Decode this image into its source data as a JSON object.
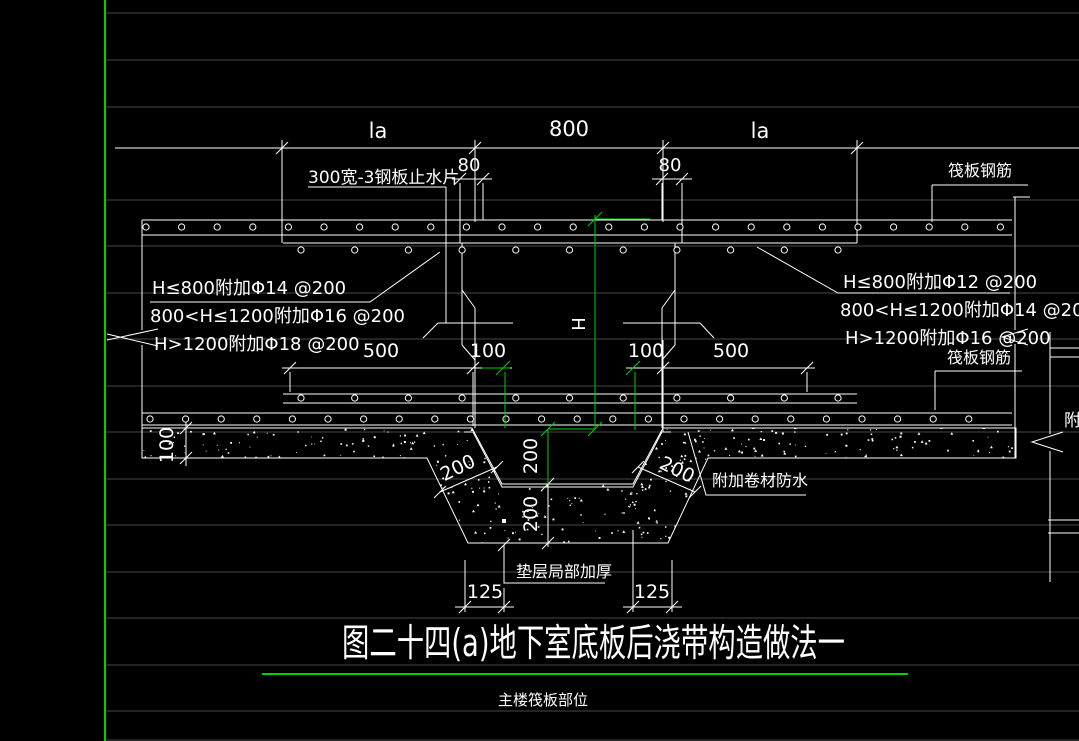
{
  "window": {
    "background": "#000000",
    "grid_color": "#474747",
    "line_color": "#ffffff",
    "accent_green": "#00cf00"
  },
  "title_block": {
    "title": "图二十四(a)地下室底板后浇带构造做法一",
    "subtitle": "主楼筏板部位"
  },
  "dimensions": {
    "top": [
      "la",
      "800",
      "la"
    ],
    "gap_left": "80",
    "gap_right": "80",
    "bottom_chain": [
      "500",
      "100",
      "100",
      "500"
    ],
    "trench_depth_upper": "200",
    "trench_depth_lower": "200",
    "slope_left": "200",
    "slope_right": "200",
    "cushion_thickness": "100",
    "bottom_offsets": [
      "125",
      "125"
    ],
    "height_symbol": "H"
  },
  "labels": {
    "steel_waterstop": "300宽-3钢板止水片",
    "raft_rebar_top": "筏板钢筋",
    "raft_rebar_bottom": "筏板钢筋",
    "waterproof_membrane": "附加卷材防水",
    "cushion_thickening": "垫层局部加厚",
    "right_edge_partial": "附加",
    "spec_left": [
      "H≤800附加Φ14 @200",
      "800<H≤1200附加Φ16 @200",
      "H>1200附加Φ18 @200"
    ],
    "spec_right": [
      "H≤800附加Φ12 @200",
      "800<H≤1200附加Φ14 @200",
      "H>1200附加Φ16 @200"
    ]
  }
}
